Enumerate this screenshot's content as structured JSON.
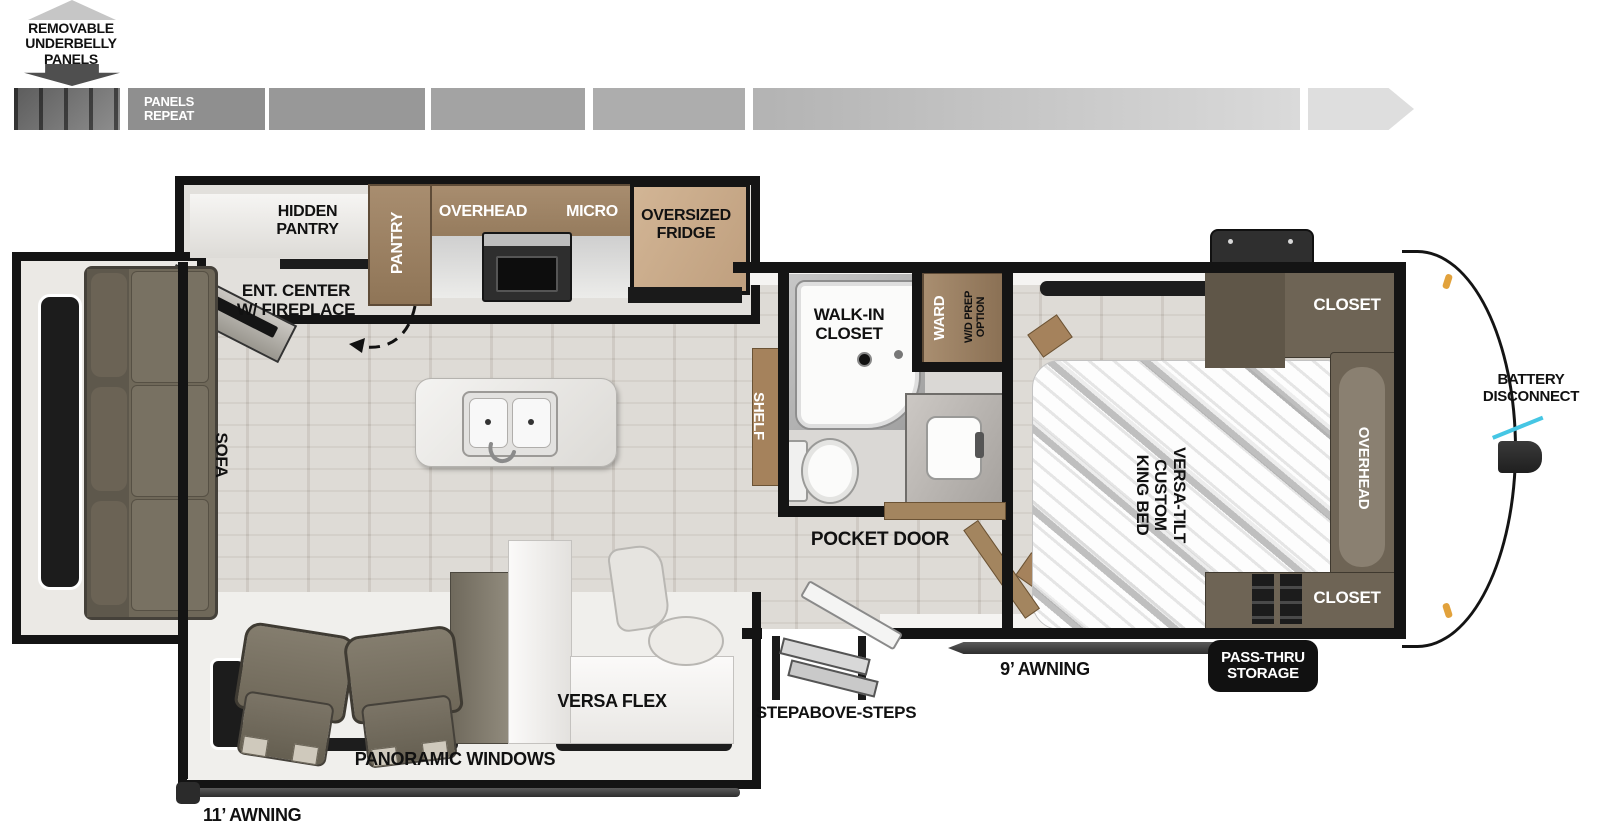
{
  "legend": {
    "underbelly": "REMOVABLE\nUNDERBELLY\nPANELS",
    "panels_repeat": "PANELS\nREPEAT"
  },
  "kitchen": {
    "hidden_pantry": "HIDDEN\nPANTRY",
    "pantry": "PANTRY",
    "overhead": "OVERHEAD",
    "micro": "MICRO",
    "fridge": "OVERSIZED\nFRIDGE"
  },
  "living": {
    "ent_center": "ENT. CENTER\nW/ FIREPLACE",
    "sofa": "SOFA",
    "versa_flex": "VERSA FLEX"
  },
  "bath": {
    "walk_in_closet": "WALK-IN\nCLOSET",
    "shelf": "SHELF",
    "ward": "WARD",
    "wd_prep": "W/D PREP\nOPTION",
    "pocket_door": "POCKET DOOR"
  },
  "bedroom": {
    "bed": "VERSA-TILT\nCUSTOM\nKING BED",
    "closet_top": "CLOSET",
    "overhead": "OVERHEAD",
    "closet_bottom": "CLOSET"
  },
  "exterior": {
    "battery_disconnect": "BATTERY\nDISCONNECT",
    "pass_thru_storage": "PASS-THRU\nSTORAGE",
    "awning_front": "9’ AWNING",
    "awning_rear": "11’ AWNING",
    "steps": "STEPABOVE-STEPS",
    "panoramic_windows": "PANORAMIC WINDOWS"
  },
  "colors": {
    "wall": "#141414",
    "cabinet_brown": "#9c8164",
    "cabinet_dark": "#6e6455",
    "wood_light": "#c8aa8c",
    "sofa_olive": "#716a5c",
    "floor": "#d8d4ce",
    "accent_cyan": "#45c6e4"
  }
}
